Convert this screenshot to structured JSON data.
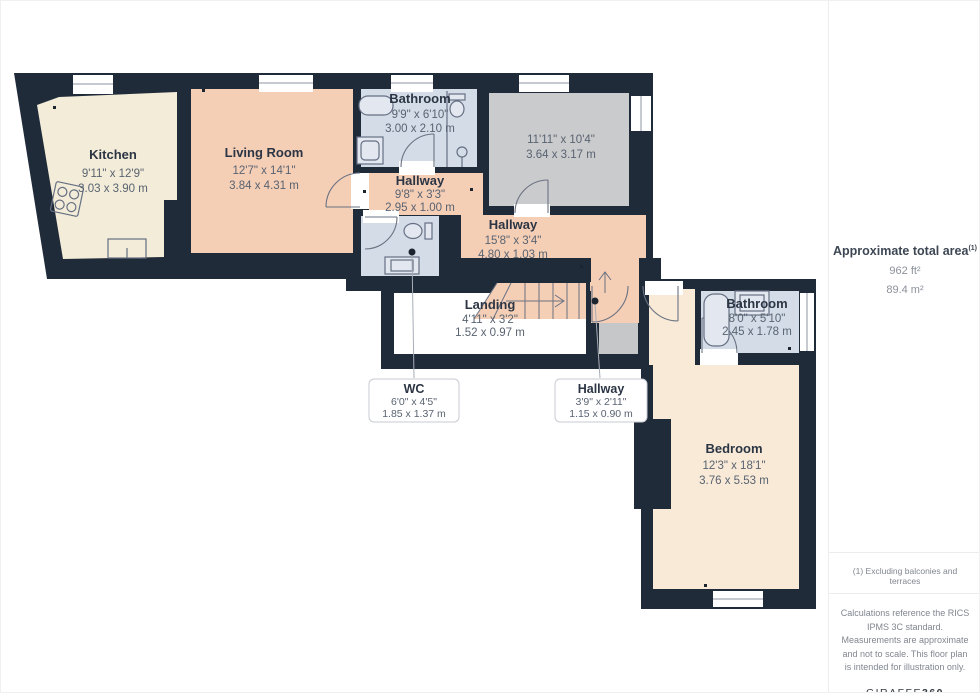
{
  "rooms": [
    {
      "name": "Kitchen",
      "dims_ft": "9'11\" x 12'9\"",
      "dims_m": "3.03 x 3.90 m"
    },
    {
      "name": "Living Room",
      "dims_ft": "12'7\" x 14'1\"",
      "dims_m": "3.84 x 4.31 m"
    },
    {
      "name": "Bathroom",
      "dims_ft": "9'9\" x 6'10\"",
      "dims_m": "3.00 x 2.10 m"
    },
    {
      "name": "",
      "dims_ft": "11'11\" x 10'4\"",
      "dims_m": "3.64 x 3.17 m"
    },
    {
      "name": "Hallway",
      "dims_ft": "9'8\" x 3'3\"",
      "dims_m": "2.95 x 1.00 m"
    },
    {
      "name": "Hallway",
      "dims_ft": "15'8\" x 3'4\"",
      "dims_m": "4.80 x 1.03 m"
    },
    {
      "name": "Landing",
      "dims_ft": "4'11\" x 3'2\"",
      "dims_m": "1.52 x 0.97 m"
    },
    {
      "name": "WC",
      "dims_ft": "6'0\" x 4'5\"",
      "dims_m": "1.85 x 1.37 m"
    },
    {
      "name": "Hallway",
      "dims_ft": "3'9\" x 2'11\"",
      "dims_m": "1.15 x 0.90 m"
    },
    {
      "name": "Bathroom",
      "dims_ft": "8'0\" x 5'10\"",
      "dims_m": "2.45 x 1.78 m"
    },
    {
      "name": "Bedroom",
      "dims_ft": "12'3\" x 18'1\"",
      "dims_m": "3.76 x 5.53 m"
    }
  ],
  "sidebar": {
    "title": "Approximate total area",
    "title_note": "(1)",
    "area_ft": "962 ft²",
    "area_m": "89.4 m²"
  },
  "footer": {
    "footnote": "(1) Excluding balconies and terraces",
    "disclaimer": "Calculations reference the RICS IPMS 3C standard. Measurements are approximate and not to scale. This floor plan is intended for illustration only.",
    "brand": "GIRAFFE",
    "brand_suffix": "360"
  },
  "colors": {
    "wall": "#202b3a",
    "hallway_salmon": "#f5ceb6",
    "kitchen_cream": "#f3ecd8",
    "bedroom_cream": "#f8ead7",
    "bathroom_blue": "#d4dce8",
    "unlabeled_gray": "#cacbcd",
    "entry_mat_gray": "#c6c7c9"
  }
}
